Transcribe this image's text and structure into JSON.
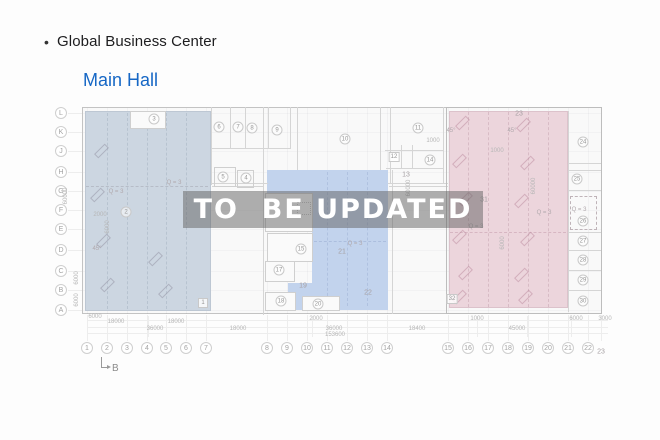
{
  "header": {
    "bullet": "•",
    "title": "Global Business Center"
  },
  "floor": {
    "title": "Main Hall"
  },
  "watermark": {
    "text": "TO  BE UPDATED"
  },
  "colors": {
    "floor_title_blue": "#1667c5",
    "region_left_fill": "#ccd6e1",
    "region_left_border": "#bdc7d3",
    "region_center_fill": "#c2d3ed",
    "region_right_fill": "#ecd5dc",
    "region_right_border": "#dcc2cb",
    "watermark_bg": "rgba(98,98,98,0.5)",
    "watermark_text": "#ffffff"
  },
  "plan": {
    "row_axis": [
      {
        "label": "L",
        "y": 113
      },
      {
        "label": "K",
        "y": 132
      },
      {
        "label": "J",
        "y": 151
      },
      {
        "label": "H",
        "y": 172
      },
      {
        "label": "G",
        "y": 191
      },
      {
        "label": "F",
        "y": 210
      },
      {
        "label": "E",
        "y": 229
      },
      {
        "label": "D",
        "y": 250
      },
      {
        "label": "C",
        "y": 271
      },
      {
        "label": "B",
        "y": 290
      },
      {
        "label": "A",
        "y": 310
      }
    ],
    "col_axis_y": 348,
    "col_axis": [
      {
        "label": "1",
        "x": 87
      },
      {
        "label": "2",
        "x": 107
      },
      {
        "label": "3",
        "x": 127
      },
      {
        "label": "4",
        "x": 147
      },
      {
        "label": "5",
        "x": 166
      },
      {
        "label": "6",
        "x": 186
      },
      {
        "label": "7",
        "x": 206
      },
      {
        "label": "8",
        "x": 267
      },
      {
        "label": "9",
        "x": 287
      },
      {
        "label": "10",
        "x": 307
      },
      {
        "label": "11",
        "x": 327
      },
      {
        "label": "12",
        "x": 347
      },
      {
        "label": "13",
        "x": 367
      },
      {
        "label": "14",
        "x": 387
      },
      {
        "label": "15",
        "x": 448
      },
      {
        "label": "16",
        "x": 468
      },
      {
        "label": "17",
        "x": 488
      },
      {
        "label": "18",
        "x": 508
      },
      {
        "label": "19",
        "x": 528
      },
      {
        "label": "20",
        "x": 548
      },
      {
        "label": "21",
        "x": 568
      },
      {
        "label": "22",
        "x": 588
      },
      {
        "label": "23",
        "x": 601,
        "y": 352,
        "plain": true
      }
    ],
    "rooms": [
      {
        "n": "1",
        "x": 203,
        "y": 303,
        "style": "box"
      },
      {
        "n": "2",
        "x": 126,
        "y": 212,
        "style": "circle"
      },
      {
        "n": "3",
        "x": 154,
        "y": 119,
        "style": "circle"
      },
      {
        "n": "4",
        "x": 246,
        "y": 178,
        "style": "circle"
      },
      {
        "n": "5",
        "x": 223,
        "y": 177,
        "style": "circle"
      },
      {
        "n": "6",
        "x": 219,
        "y": 127,
        "style": "circle"
      },
      {
        "n": "7",
        "x": 238,
        "y": 127,
        "style": "circle"
      },
      {
        "n": "8",
        "x": 252,
        "y": 128,
        "style": "circle"
      },
      {
        "n": "9",
        "x": 277,
        "y": 130,
        "style": "circle"
      },
      {
        "n": "10",
        "x": 345,
        "y": 139,
        "style": "circle"
      },
      {
        "n": "11",
        "x": 418,
        "y": 128,
        "style": "circle"
      },
      {
        "n": "12",
        "x": 394,
        "y": 157,
        "style": "box"
      },
      {
        "n": "13",
        "x": 406,
        "y": 175,
        "style": "plain"
      },
      {
        "n": "14",
        "x": 430,
        "y": 160,
        "style": "circle"
      },
      {
        "n": "15",
        "x": 301,
        "y": 249,
        "style": "circle"
      },
      {
        "n": "17",
        "x": 279,
        "y": 270,
        "style": "circle"
      },
      {
        "n": "18",
        "x": 281,
        "y": 301,
        "style": "circle"
      },
      {
        "n": "19",
        "x": 303,
        "y": 286,
        "style": "plain"
      },
      {
        "n": "20",
        "x": 318,
        "y": 304,
        "style": "circle"
      },
      {
        "n": "21",
        "x": 342,
        "y": 252,
        "style": "plain"
      },
      {
        "n": "22",
        "x": 368,
        "y": 293,
        "style": "plain"
      },
      {
        "n": "23",
        "x": 519,
        "y": 114,
        "style": "plain"
      },
      {
        "n": "24",
        "x": 583,
        "y": 142,
        "style": "circle"
      },
      {
        "n": "25",
        "x": 577,
        "y": 179,
        "style": "circle"
      },
      {
        "n": "26",
        "x": 583,
        "y": 221,
        "style": "circle"
      },
      {
        "n": "27",
        "x": 583,
        "y": 241,
        "style": "circle"
      },
      {
        "n": "28",
        "x": 583,
        "y": 260,
        "style": "circle"
      },
      {
        "n": "29",
        "x": 583,
        "y": 280,
        "style": "circle"
      },
      {
        "n": "30",
        "x": 583,
        "y": 301,
        "style": "circle"
      },
      {
        "n": "31",
        "x": 484,
        "y": 200,
        "style": "plain"
      },
      {
        "n": "32",
        "x": 452,
        "y": 299,
        "style": "box"
      }
    ],
    "notes": [
      {
        "t": "Q = 3",
        "x": 116,
        "y": 192
      },
      {
        "t": "Q = 3",
        "x": 174,
        "y": 183
      },
      {
        "t": "Q = 3",
        "x": 355,
        "y": 244
      },
      {
        "t": "Q = 3",
        "x": 476,
        "y": 227
      },
      {
        "t": "Q = 3",
        "x": 544,
        "y": 213
      },
      {
        "t": "Q = 3",
        "x": 579,
        "y": 210
      },
      {
        "t": "45°",
        "x": 97,
        "y": 249
      },
      {
        "t": "45°",
        "x": 451,
        "y": 131
      },
      {
        "t": "45°",
        "x": 512,
        "y": 131
      }
    ],
    "dims": [
      {
        "t": "6000",
        "x": 95,
        "y": 317
      },
      {
        "t": "18000",
        "x": 116,
        "y": 322
      },
      {
        "t": "18000",
        "x": 176,
        "y": 322
      },
      {
        "t": "36000",
        "x": 155,
        "y": 329
      },
      {
        "t": "18000",
        "x": 238,
        "y": 329
      },
      {
        "t": "2000",
        "x": 316,
        "y": 319
      },
      {
        "t": "36000",
        "x": 334,
        "y": 329
      },
      {
        "t": "153600",
        "x": 335,
        "y": 335
      },
      {
        "t": "18400",
        "x": 417,
        "y": 329
      },
      {
        "t": "1000",
        "x": 477,
        "y": 319
      },
      {
        "t": "45000",
        "x": 517,
        "y": 329
      },
      {
        "t": "6000",
        "x": 576,
        "y": 319
      },
      {
        "t": "3000",
        "x": 605,
        "y": 319
      },
      {
        "t": "1000",
        "x": 433,
        "y": 141
      },
      {
        "t": "1000",
        "x": 497,
        "y": 151
      },
      {
        "t": "2000",
        "x": 100,
        "y": 215
      },
      {
        "t": "60000",
        "x": 66,
        "y": 196,
        "rot": true
      },
      {
        "t": "6000",
        "x": 77,
        "y": 278,
        "rot": true
      },
      {
        "t": "6000",
        "x": 77,
        "y": 300,
        "rot": true
      },
      {
        "t": "6000",
        "x": 108,
        "y": 227,
        "rot": true
      },
      {
        "t": "60000",
        "x": 409,
        "y": 188,
        "rot": true
      },
      {
        "t": "6000",
        "x": 503,
        "y": 243,
        "rot": true
      },
      {
        "t": "60000",
        "x": 534,
        "y": 186,
        "rot": true
      }
    ],
    "section_marker": {
      "label": "B"
    }
  }
}
